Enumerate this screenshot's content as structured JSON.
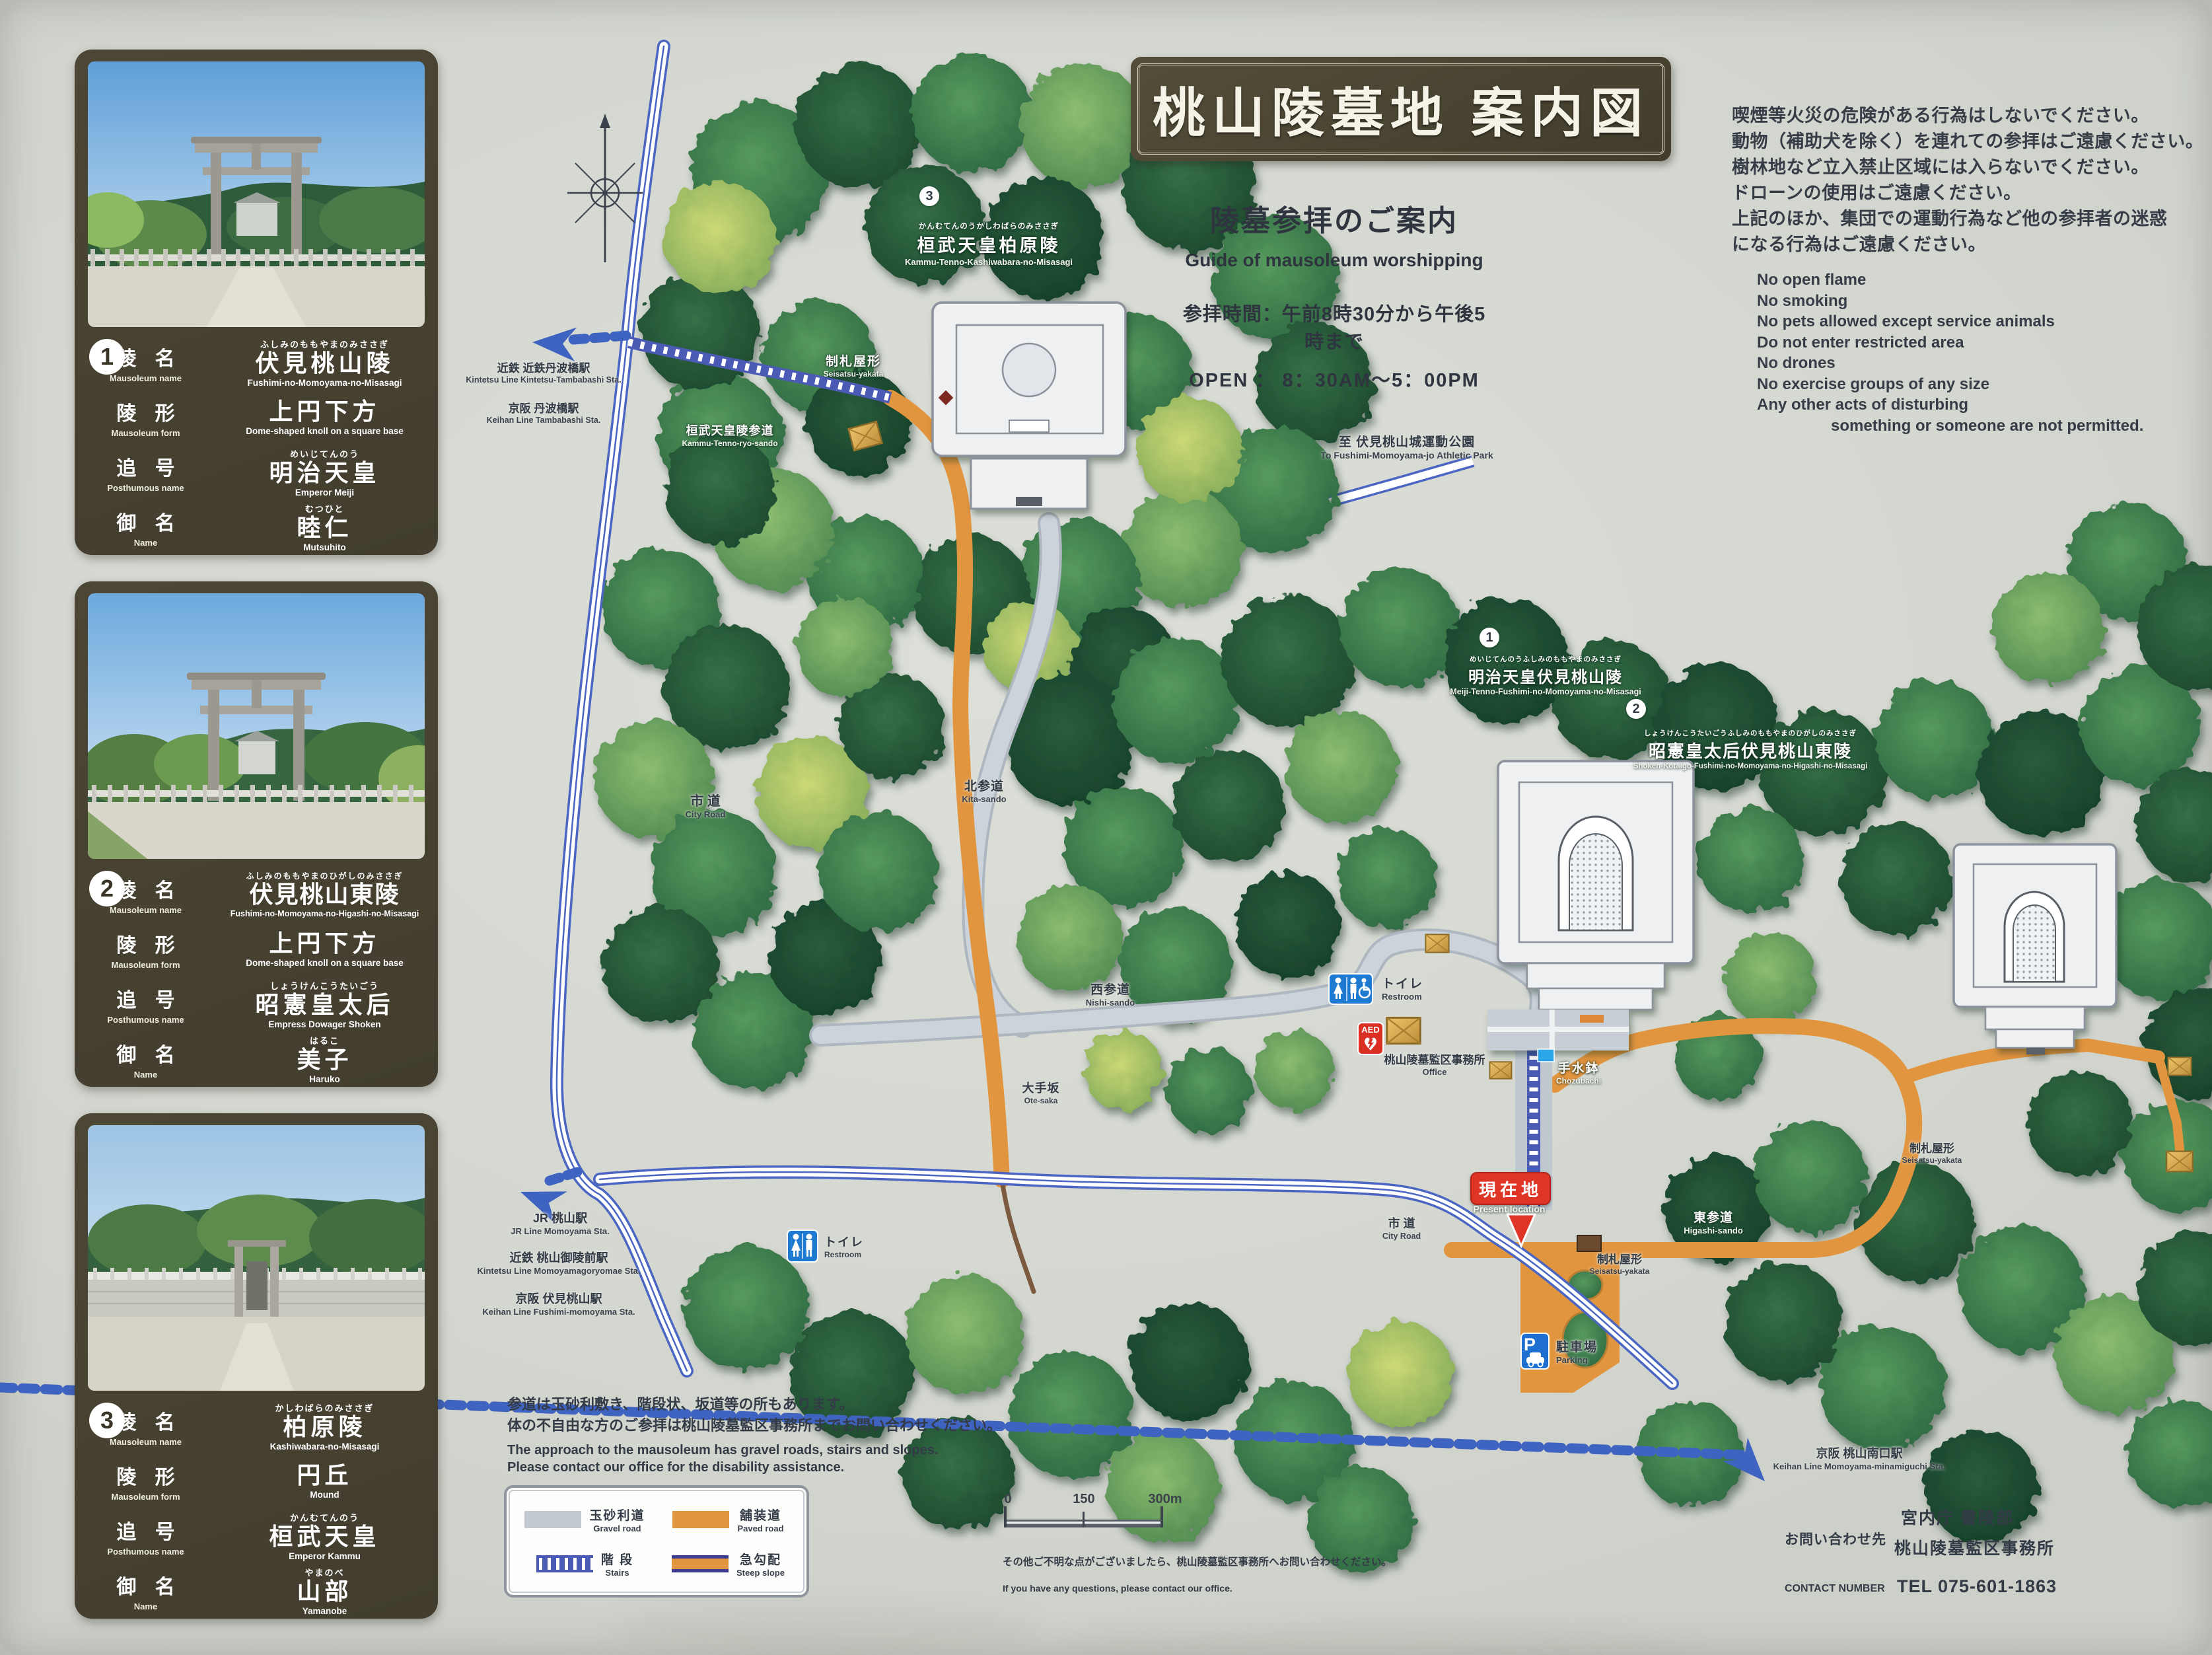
{
  "title": "桃山陵墓地 案内図",
  "guide": {
    "heading_jp": "陵墓参拝のご案内",
    "heading_en": "Guide of mausoleum worshipping",
    "hours_jp": "参拝時間：午前8時30分から午後5時まで",
    "hours_en": "OPEN ： 8：30AM～5：00PM"
  },
  "rules": {
    "jp": [
      "喫煙等火災の危険がある行為はしないでください。",
      "動物（補助犬を除く）を連れての参拝はご遠慮ください。",
      "樹林地など立入禁止区域には入らないでください。",
      "ドローンの使用はご遠慮ください。",
      "上記のほか、集団での運動行為など他の参拝者の迷惑",
      "になる行為はご遠慮ください。"
    ],
    "en": [
      "No open flame",
      "No smoking",
      "No pets allowed except service animals",
      "Do not enter restricted area",
      "No drones",
      "No exercise groups of any size",
      "Any other acts of disturbing"
    ],
    "en_footer": "something or someone are not permitted."
  },
  "panels": [
    {
      "num": "1",
      "rows": [
        {
          "label_jp": "陵 名",
          "label_en": "Mausoleum name",
          "furi": "ふしみのももやまのみささぎ",
          "value_jp": "伏見桃山陵",
          "value_en": "Fushimi-no-Momoyama-no-Misasagi"
        },
        {
          "label_jp": "陵 形",
          "label_en": "Mausoleum form",
          "furi": "",
          "value_jp": "上円下方",
          "value_en": "Dome-shaped knoll on a square base"
        },
        {
          "label_jp": "追 号",
          "label_en": "Posthumous name",
          "furi": "めいじてんのう",
          "value_jp": "明治天皇",
          "value_en": "Emperor Meiji"
        },
        {
          "label_jp": "御 名",
          "label_en": "Name",
          "furi": "むつひと",
          "value_jp": "睦仁",
          "value_en": "Mutsuhito"
        }
      ]
    },
    {
      "num": "2",
      "rows": [
        {
          "label_jp": "陵 名",
          "label_en": "Mausoleum name",
          "furi": "ふしみのももやまのひがしのみささぎ",
          "value_jp": "伏見桃山東陵",
          "value_en": "Fushimi-no-Momoyama-no-Higashi-no-Misasagi"
        },
        {
          "label_jp": "陵 形",
          "label_en": "Mausoleum form",
          "furi": "",
          "value_jp": "上円下方",
          "value_en": "Dome-shaped knoll on a square base"
        },
        {
          "label_jp": "追 号",
          "label_en": "Posthumous name",
          "furi": "しょうけんこうたいごう",
          "value_jp": "昭憲皇太后",
          "value_en": "Empress Dowager Shoken"
        },
        {
          "label_jp": "御 名",
          "label_en": "Name",
          "furi": "はるこ",
          "value_jp": "美子",
          "value_en": "Haruko"
        }
      ]
    },
    {
      "num": "3",
      "rows": [
        {
          "label_jp": "陵 名",
          "label_en": "Mausoleum name",
          "furi": "かしわばらのみささぎ",
          "value_jp": "柏原陵",
          "value_en": "Kashiwabara-no-Misasagi"
        },
        {
          "label_jp": "陵 形",
          "label_en": "Mausoleum form",
          "furi": "",
          "value_jp": "円丘",
          "value_en": "Mound"
        },
        {
          "label_jp": "追 号",
          "label_en": "Posthumous name",
          "furi": "かんむてんのう",
          "value_jp": "桓武天皇",
          "value_en": "Emperor Kammu"
        },
        {
          "label_jp": "御 名",
          "label_en": "Name",
          "furi": "やまのべ",
          "value_jp": "山部",
          "value_en": "Yamanobe"
        }
      ]
    }
  ],
  "map": {
    "m3": {
      "num": "3",
      "furi": "かんむてんのうかしわばらのみささぎ",
      "jp": "桓武天皇柏原陵",
      "en": "Kammu-Tenno-Kashiwabara-no-Misasagi"
    },
    "m1": {
      "num": "1",
      "furi": "めいじてんのうふしみのももやまのみささぎ",
      "jp": "明治天皇伏見桃山陵",
      "en": "Meiji-Tenno-Fushimi-no-Momoyama-no-Misasagi"
    },
    "m2": {
      "num": "2",
      "furi": "しょうけんこうたいごうふしみのももやまのひがしのみささぎ",
      "jp": "昭憲皇太后伏見桃山東陵",
      "en": "Shoken-Kotaigo-Fushimi-no-Momoyama-no-Higashi-no-Misasagi"
    },
    "seisatsu": {
      "jp": "制札屋形",
      "en": "Seisatsu-yakata"
    },
    "kammu_sando": {
      "jp": "桓武天皇陵参道",
      "en": "Kammu-Tenno-ryo-sando"
    },
    "kintetsu_tambabashi": {
      "jp": "近鉄 近鉄丹波橋駅",
      "en": "Kintetsu Line Kintetsu-Tambabashi Sta."
    },
    "keihan_tambabashi": {
      "jp": "京阪 丹波橋駅",
      "en": "Keihan Line Tambabashi Sta."
    },
    "athletic": {
      "jp": "至 伏見桃山城運動公園",
      "en": "To Fushimi-Momoyama-jo Athletic Park"
    },
    "city_road": {
      "jp": "市 道",
      "en": "City Road"
    },
    "kita_sando": {
      "jp": "北参道",
      "en": "Kita-sando"
    },
    "nishi_sando": {
      "jp": "西参道",
      "en": "Nishi-sando"
    },
    "ote_saka": {
      "jp": "大手坂",
      "en": "Ote-saka"
    },
    "toilet": {
      "jp": "トイレ",
      "en": "Restroom"
    },
    "aed": {
      "label": "AED"
    },
    "office": {
      "jp": "桃山陵墓監区事務所",
      "en": "Office"
    },
    "chozubachi": {
      "jp": "手水鉢",
      "en": "Chozubachi"
    },
    "present": {
      "jp": "現在地",
      "en": "Present location"
    },
    "higashi_sando": {
      "jp": "東参道",
      "en": "Higashi-sando"
    },
    "jr_momoyama": {
      "jp": "JR 桃山駅",
      "en": "JR Line Momoyama Sta."
    },
    "kintetsu_goryomae": {
      "jp": "近鉄 桃山御陵前駅",
      "en": "Kintetsu Line Momoyamagoryomae Sta."
    },
    "keihan_fushimi": {
      "jp": "京阪 伏見桃山駅",
      "en": "Keihan Line Fushimi-momoyama Sta."
    },
    "parking": {
      "jp": "駐車場",
      "en": "Parking",
      "icon": "P"
    },
    "keihan_minamiguchi": {
      "jp": "京阪 桃山南口駅",
      "en": "Keihan Line Momoyama-minamiguchi Sta."
    }
  },
  "legend": {
    "gravel_jp": "玉砂利道",
    "gravel_en": "Gravel road",
    "paved_jp": "舗装道",
    "paved_en": "Paved road",
    "stairs_jp": "階 段",
    "stairs_en": "Stairs",
    "steep_jp": "急勾配",
    "steep_en": "Steep slope"
  },
  "scale": {
    "t0": "0",
    "t1": "150",
    "t2": "300m"
  },
  "notes": {
    "approach_jp1": "参道は玉砂利敷き、階段状、坂道等の所もあります。",
    "approach_jp2": "体の不自由な方のご参拝は桃山陵墓監区事務所までお問い合わせください。",
    "approach_en1": "The approach to the mausoleum has gravel roads, stairs and slopes.",
    "approach_en2": "Please contact our office for the disability assistance.",
    "questions_jp": "その他ご不明な点がございましたら、桃山陵墓監区事務所へお問い合わせください。",
    "questions_en": "If you have any questions, please contact our office."
  },
  "contact": {
    "label_jp": "お問い合わせ先",
    "org1": "宮内庁 書陵部",
    "org2": "桃山陵墓監区事務所",
    "label_en": "CONTACT NUMBER",
    "tel": "TEL 075-601-1863"
  },
  "colors": {
    "accent_paved": "#e2953f",
    "accent_rail": "#3f63c0",
    "accent_present": "#df3526",
    "panel_bg": "#474133"
  }
}
